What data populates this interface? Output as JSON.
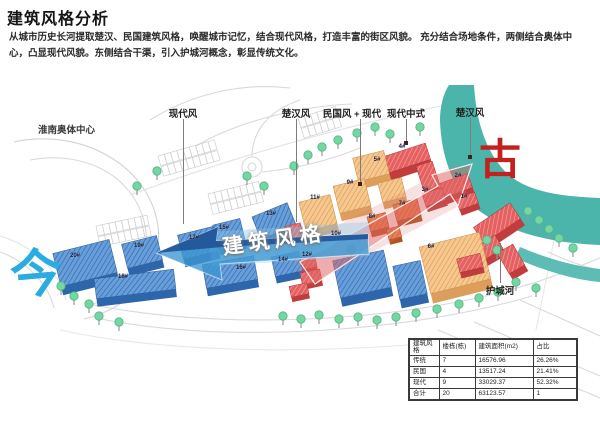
{
  "header": {
    "title": "建筑风格分析",
    "description": "从城市历史长河提取楚汉、民国建筑风格，唤醒城市记忆，结合现代风格，打造丰富的街区风貌。 充分结合场地条件，两侧结合奥体中心，凸显现代风貌。东侧结合干渠，引入护城河概念，彰显传统文化。"
  },
  "map": {
    "stadium_label": "淮南奥体中心",
    "moat_label": "护城河",
    "axis_text": "建筑风格",
    "era_now": "今",
    "era_ancient": "古",
    "style_labels": [
      {
        "label": "现代风"
      },
      {
        "label": "楚汉风"
      },
      {
        "label": "民国风 + 现代"
      },
      {
        "label": "现代中式"
      },
      {
        "label": "楚汉风"
      }
    ],
    "building_labels": [
      "20#",
      "19#",
      "18#",
      "17#",
      "16#",
      "15#",
      "14#",
      "13#",
      "12#",
      "11#",
      "10#",
      "9#",
      "8#",
      "7#",
      "6#",
      "5#",
      "4#",
      "3#",
      "2#",
      "1#"
    ]
  },
  "legend_colors": {
    "modern_blue": "#5e9bd8",
    "minguo_orange": "#f6c88f",
    "accent_dark_orange": "#e2743c",
    "chuhan_red": "#e25858",
    "water_teal": "#4bb5ab",
    "era_now_blue": "#2aabe2",
    "era_ancient_red": "#c32020"
  },
  "table": {
    "headers": [
      "建筑风格",
      "楼栋(栋)",
      "建筑面积(m2)",
      "占比"
    ],
    "rows": [
      [
        "传统",
        "7",
        "16576.96",
        "26.26%"
      ],
      [
        "民国",
        "4",
        "13517.24",
        "21.41%"
      ],
      [
        "现代",
        "9",
        "33029.37",
        "52.32%"
      ],
      [
        "合计",
        "20",
        "63123.57",
        "1"
      ]
    ]
  }
}
